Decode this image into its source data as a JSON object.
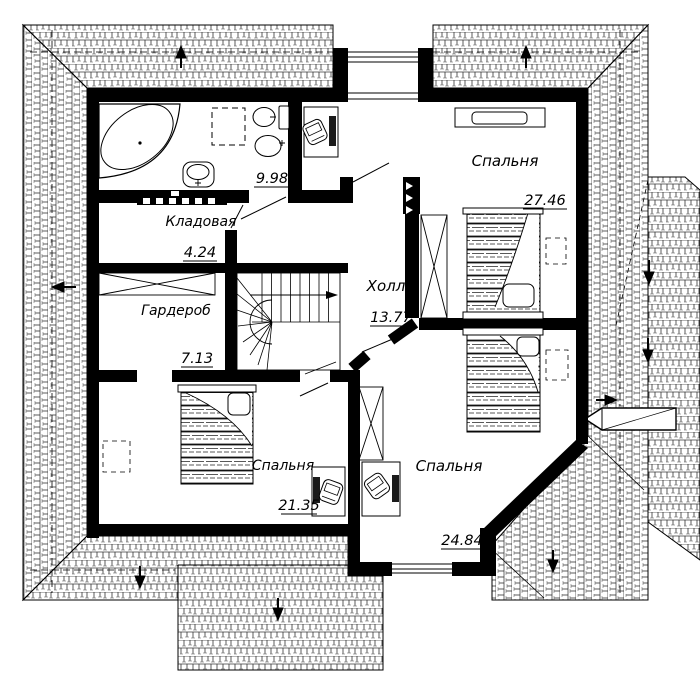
{
  "drawing": {
    "kind": "floor-plan",
    "language": "ru"
  },
  "rooms": {
    "bathroom": {
      "area": "9.98"
    },
    "storage": {
      "label": "Кладовая",
      "area": "4.24"
    },
    "wardrobe": {
      "label": "Гардероб",
      "area": "7.13"
    },
    "hall": {
      "label": "Холл",
      "area": "13.77"
    },
    "bedroom_top": {
      "label": "Спальня",
      "area": "27.46"
    },
    "bedroom_left": {
      "label": "Спальня",
      "area": "21.35"
    },
    "bedroom_right": {
      "label": "Спальня",
      "area": "24.84"
    }
  },
  "colors": {
    "ink": "#000000",
    "paper": "#ffffff"
  }
}
